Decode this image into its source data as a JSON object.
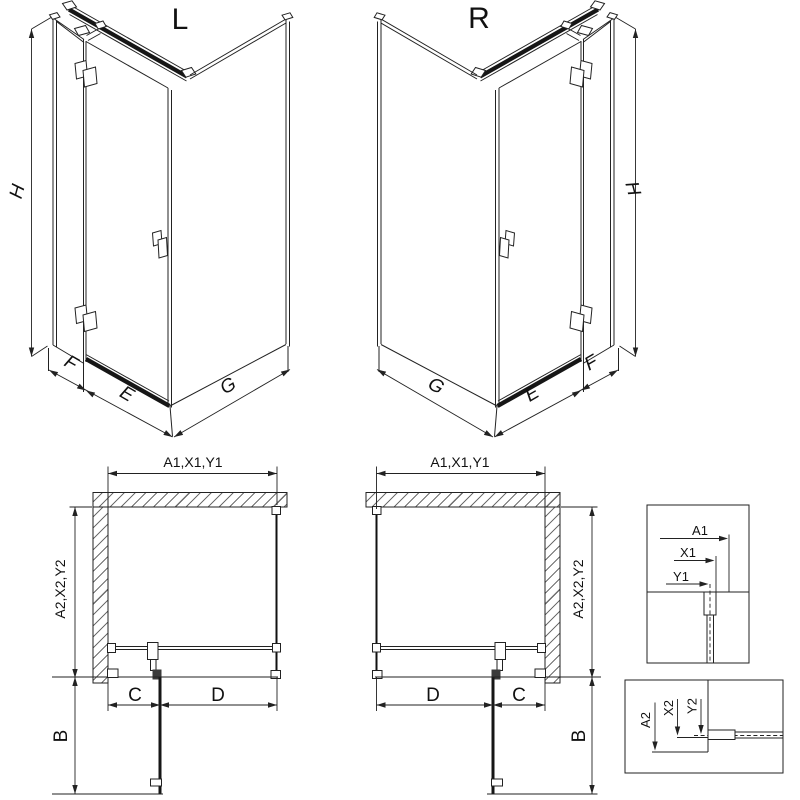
{
  "drawing": {
    "iso_left": {
      "title": "L",
      "h": "H",
      "f": "F",
      "e": "E",
      "g": "G"
    },
    "iso_right": {
      "title": "R",
      "h": "H",
      "f": "F",
      "e": "E",
      "g": "G"
    },
    "plan_left": {
      "width_dim": "A1,X1,Y1",
      "depth_dim": "A2,X2,Y2",
      "c": "C",
      "d": "D",
      "b": "B"
    },
    "plan_right": {
      "width_dim": "A1,X1,Y1",
      "depth_dim": "A2,X2,Y2",
      "c": "C",
      "d": "D",
      "b": "B"
    },
    "detail_top": {
      "a1": "A1",
      "x1": "X1",
      "y1": "Y1"
    },
    "detail_bottom": {
      "a2": "A2",
      "x2": "X2",
      "y2": "Y2"
    },
    "colors": {
      "line": "#222222",
      "dark_profile": "#161616",
      "hatch": "#6e6e6e",
      "background": "#ffffff"
    }
  }
}
